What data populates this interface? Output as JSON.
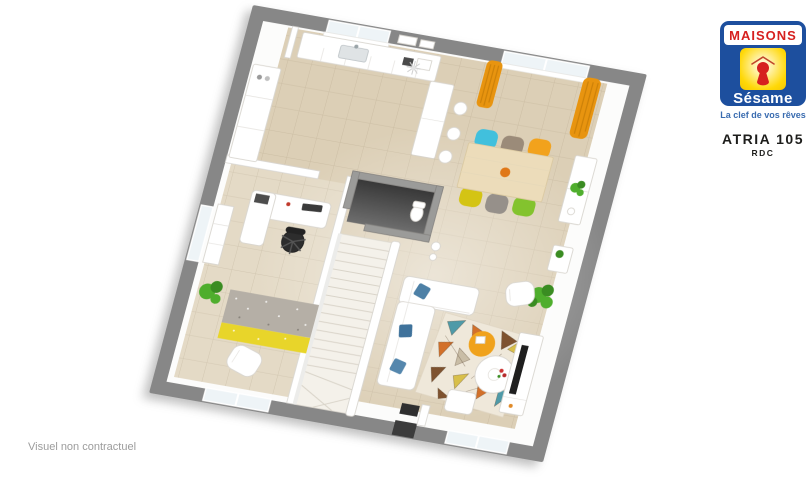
{
  "branding": {
    "brand_top": "MAISONS",
    "brand_bottom": "Sésame",
    "tagline": "La clef de vos rêves",
    "model_name": "ATRIA 105",
    "floor_label": "RDC"
  },
  "footer": {
    "disclaimer": "Visuel non contractuel"
  },
  "floorplan": {
    "type": "3d-rendered-floor-plan",
    "floor": "RDC (rez-de-chaussée)",
    "rotation_deg": 10,
    "areas": [
      "open-kitchen",
      "dining-area",
      "living-area",
      "office",
      "wc",
      "staircase",
      "entrance-hall"
    ],
    "furniture": [
      "kitchen-counter",
      "kitchen-peninsula-bar",
      "bar-stools",
      "tall-cabinets",
      "dining-table",
      "six-colored-chairs",
      "sideboard",
      "console",
      "sofa-l-shape",
      "geometric-rug",
      "orange-pouf",
      "round-table",
      "armchair",
      "tv-unit",
      "office-desk",
      "office-chair",
      "office-shelf",
      "speckled-rug",
      "office-armchair",
      "plants",
      "orange-curtains"
    ]
  },
  "palette": {
    "wall_gray": "#878787",
    "floor_beige": "#dccfb6",
    "floor_beige_light": "#e4dac6",
    "wood_light": "#ecdcba",
    "curtain_orange": "#e8940f",
    "chair_cyan": "#41c0dd",
    "chair_taupe": "#9b8b79",
    "chair_orange": "#f2a21c",
    "chair_yellow": "#d4c414",
    "chair_gray": "#96908a",
    "chair_green": "#83c32e",
    "pouf_orange": "#f0a21c",
    "rug_cream": "#efe8da",
    "rug_teal": "#4f9aa8",
    "rug_orange": "#d2702a",
    "rug_brown": "#7e522f",
    "rug_mustard": "#d8bf4a",
    "office_rug_gray": "#b5afa6",
    "office_rug_yellow": "#e8d52a",
    "plant_green": "#4fae2d",
    "plant_green_dark": "#3a8c22",
    "dark_floor": "#4a4a4a",
    "brand_blue": "#1d4f9e",
    "brand_red": "#d6201f",
    "brand_yellow": "#ffd807",
    "tagline_blue": "#3a6cb0",
    "text_dark": "#1d1d1b",
    "disclaimer_gray": "#9c9c9c"
  }
}
